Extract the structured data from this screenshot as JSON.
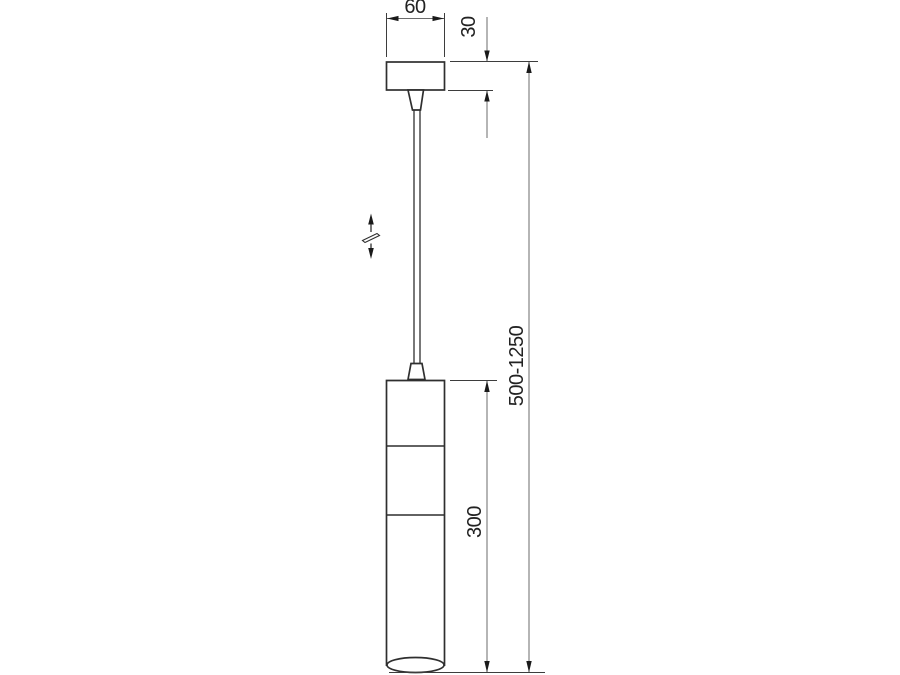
{
  "labels": {
    "canopy_width": "60",
    "canopy_height": "30",
    "overall_height": "500-1250",
    "body_height": "300"
  },
  "colors": {
    "background": "#ffffff",
    "outline": "#2f2f2f",
    "extension_line": "#3d3d3d",
    "dimension_line": "#6b6b6b",
    "arrow": "#1a1a1a",
    "label_text": "#222222"
  }
}
